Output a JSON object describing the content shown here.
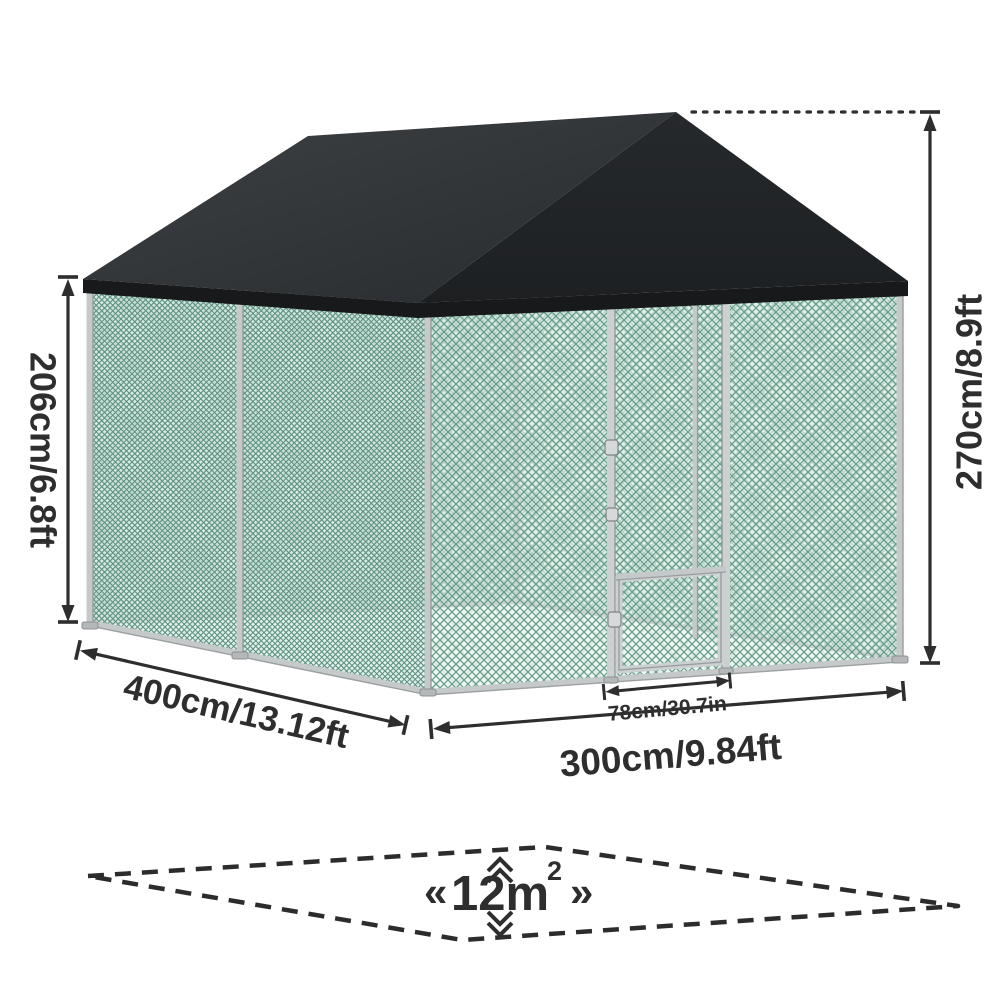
{
  "figure": {
    "subject": "Outdoor walk-in pet enclosure / chicken run with black peaked roof cover and chain-link mesh walls",
    "type": "product-dimension-diagram"
  },
  "labels": {
    "wall_height": "206cm/6.8ft",
    "total_height": "270cm/8.9ft",
    "depth": "400cm/13.12ft",
    "width": "300cm/9.84ft",
    "door_width": "78cm/30.7in",
    "area_open": "«",
    "area_value": "12m",
    "area_exponent": "2",
    "area_close": "»"
  },
  "measurements": [
    {
      "name": "side wall height",
      "value": "206cm/6.8ft"
    },
    {
      "name": "overall peak height",
      "value": "270cm/8.9ft"
    },
    {
      "name": "run depth (side)",
      "value": "400cm/13.12ft"
    },
    {
      "name": "run width (front)",
      "value": "300cm/9.84ft"
    },
    {
      "name": "door width",
      "value": "78cm/30.7in"
    },
    {
      "name": "floor area",
      "value": "12m²"
    }
  ],
  "colors": {
    "ink": "#2e2e2e",
    "roof_left_plane": "#34383b",
    "roof_front_gable": "#232629",
    "roof_fascia": "#17191b",
    "mesh_line": "#639488",
    "frame_silver": "#c7cacb",
    "background": "#ffffff"
  }
}
